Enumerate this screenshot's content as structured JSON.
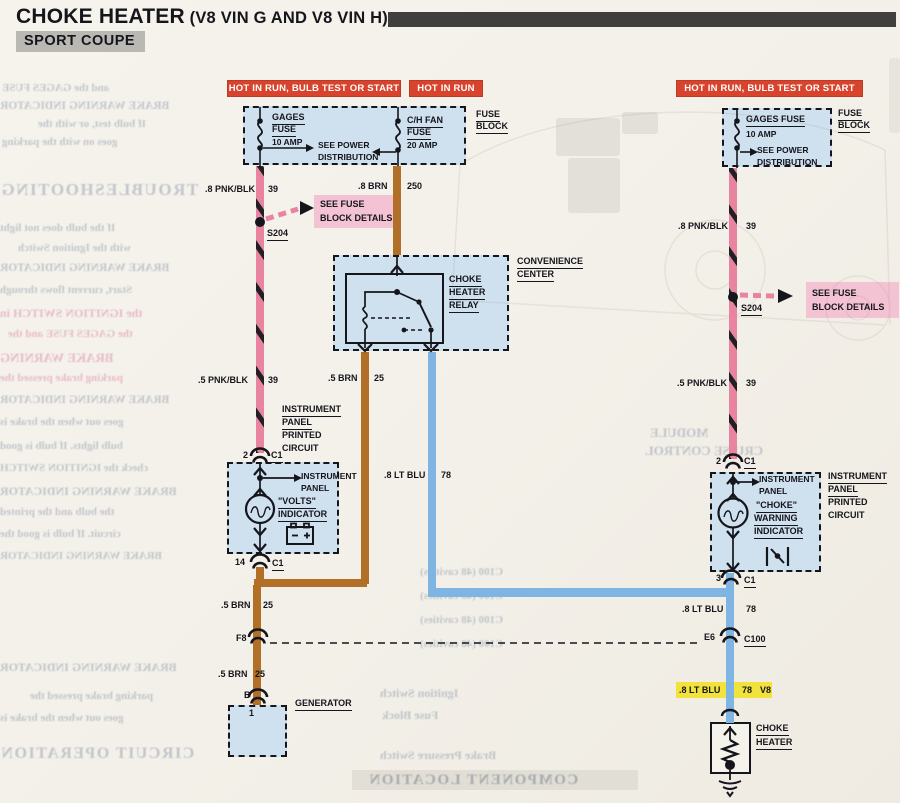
{
  "header": {
    "title": "CHOKE HEATER",
    "title_suffix": " (V8 VIN G AND V8 VIN H)",
    "subtitle": "SPORT COUPE"
  },
  "banners": {
    "left": "HOT IN RUN,  BULB TEST OR START",
    "center": "HOT IN RUN",
    "right": "HOT IN RUN,  BULB TEST OR START"
  },
  "fuse_block_left": {
    "gages_name1": "GAGES",
    "gages_name2": "FUSE",
    "gages_rating": "10 AMP",
    "see_power1": "SEE POWER",
    "see_power2": "DISTRIBUTION",
    "chfan_name1": "C/H FAN",
    "chfan_name2": "FUSE",
    "chfan_rating": "20 AMP",
    "block_label1": "FUSE",
    "block_label2": "BLOCK"
  },
  "fuse_block_right": {
    "gages_name": "GAGES FUSE",
    "gages_rating": "10 AMP",
    "see_power1": "SEE POWER",
    "see_power2": "DISTRIBUTION",
    "block_label1": "FUSE",
    "block_label2": "BLOCK"
  },
  "wire_labels": {
    "pnk_upper_left": {
      "gauge": ".8 PNK/BLK",
      "circuit": "39"
    },
    "pnk_lower_left": {
      "gauge": ".5 PNK/BLK",
      "circuit": "39"
    },
    "pnk_upper_right": {
      "gauge": ".8 PNK/BLK",
      "circuit": "39"
    },
    "pnk_lower_right": {
      "gauge": ".5 PNK/BLK",
      "circuit": "39"
    },
    "brn_chfan": {
      "gauge": ".8 BRN",
      "circuit": "250"
    },
    "brn_relay": {
      "gauge": ".5 BRN",
      "circuit": "25"
    },
    "brn_lower1": {
      "gauge": ".5 BRN",
      "circuit": "25"
    },
    "brn_lower2": {
      "gauge": ".5 BRN",
      "circuit": "25"
    },
    "blu_mid": {
      "gauge": ".8 LT BLU",
      "circuit": "78"
    },
    "blu_right": {
      "gauge": ".8 LT BLU",
      "circuit": "78"
    },
    "blu_highlight": {
      "gauge": ".8 LT BLU",
      "circuit": "78",
      "engine": "V8"
    }
  },
  "splices": {
    "left": "S204",
    "right": "S204"
  },
  "see_fuse": {
    "line1": "SEE FUSE",
    "line2": "BLOCK DETAILS"
  },
  "convenience_center": {
    "label1": "CONVENIENCE",
    "label2": "CENTER",
    "relay1": "CHOKE",
    "relay2": "HEATER",
    "relay3": "RELAY"
  },
  "left_panel": {
    "outside1": "INSTRUMENT",
    "outside2": "PANEL",
    "outside3": "PRINTED",
    "outside4": "CIRCUIT",
    "inside1": "INSTRUMENT",
    "inside2": "PANEL",
    "ind1": "\"VOLTS\"",
    "ind2": "INDICATOR",
    "conn_top_pin": "2",
    "conn_top": "C1",
    "conn_bot_pin": "14",
    "conn_bot": "C1"
  },
  "right_panel": {
    "outside1": "INSTRUMENT",
    "outside2": "PANEL",
    "outside3": "PRINTED",
    "outside4": "CIRCUIT",
    "inside1": "INSTRUMENT",
    "inside2": "PANEL",
    "ind1": "\"CHOKE\"",
    "ind2": "WARNING",
    "ind3": "INDICATOR",
    "conn_top_pin": "2",
    "conn_top": "C1",
    "conn_bot_pin": "3",
    "conn_bot": "C1"
  },
  "bulkhead": {
    "left_pin": "F8",
    "right_pin": "E6",
    "right_conn": "C100"
  },
  "generator": {
    "label": "GENERATOR",
    "pin": "B",
    "terminal": "1"
  },
  "choke_heater": {
    "label1": "CHOKE",
    "label2": "HEATER"
  },
  "colors": {
    "banner_red": "#d8432e",
    "wire_pink": "#e8849f",
    "wire_brown": "#b26f28",
    "wire_blue": "#7fb5e3",
    "box_fill": "#cfe0ef",
    "highlight_pink": "#f3c3d3",
    "highlight_yellow": "#f2e23c",
    "subtitle_gray": "#b9b8b2"
  },
  "bleedthrough": {
    "lines": [
      "and the GAGES FUSE",
      "BRAKE WARNING INDICATOR",
      "If bulb test, or with the",
      "goes on with the parking",
      "TROUBLESHOOTING",
      "If the bulb does not light",
      "with the Ignition Switch",
      "BRAKE WARNING INDICATOR",
      "Start, current flows through",
      "the IGNITION SWITCH in",
      "the GAGES FUSE and the",
      "BRAKE WARNING",
      "parking brake pressed the",
      "BRAKE WARNING INDICATOR",
      "goes out when the brake is",
      "bulb lights. If bulb is good",
      "check the IGNITION SWITCH",
      "BRAKE WARNING INDICATOR",
      "the bulb and the printed",
      "circuit. If bulb is good the",
      "BRAKE WARNING INDICATOR",
      "CIRCUIT OPERATION",
      "C100 (48 cavities)",
      "C100 (48 cavities)",
      "C100 (48 cavities)",
      "C100 (48 cavities)",
      "Ignition Switch",
      "Fuse Block",
      "Brake Pressure Switch",
      "COMPONENT LOCATION",
      "MODULE",
      "CRUISE CONTROL"
    ]
  }
}
